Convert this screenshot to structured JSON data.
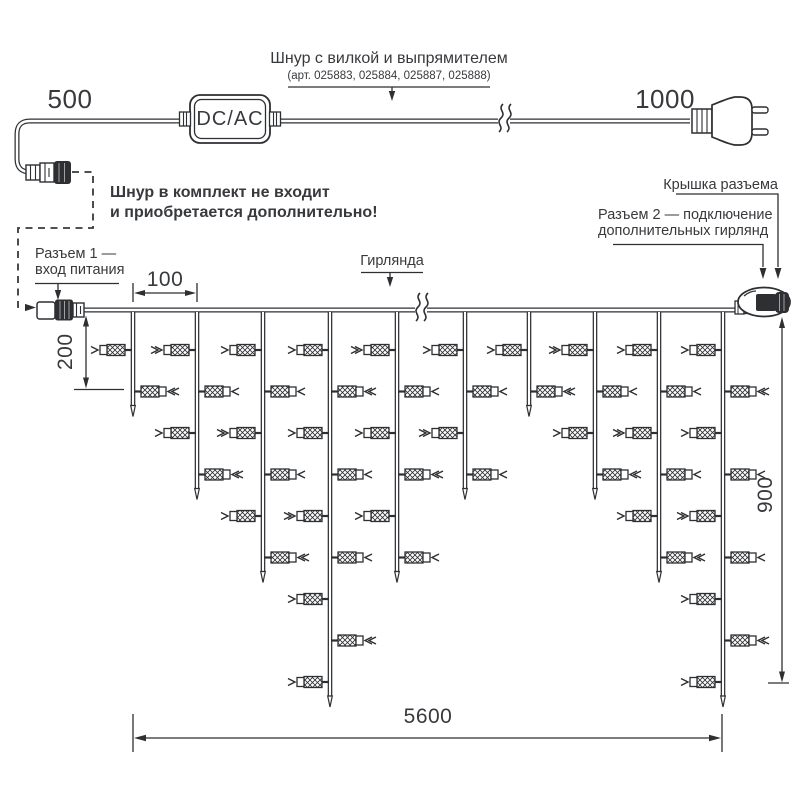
{
  "labels": {
    "cord_title": "Шнур с вилкой и выпрямителем",
    "cord_articles": "(арт. 025883, 025884, 025887, 025888)",
    "dim_500": "500",
    "dim_1000": "1000",
    "adapter": "DC/AC",
    "note_line1": "Шнур в комплект не входит",
    "note_line2": "и приобретается дополнительно!",
    "connector1_line1": "Разъем 1 —",
    "connector1_line2": "вход питания",
    "garland": "Гирлянда",
    "cap_label": "Крышка разъема",
    "connector2_line1": "Разъем 2 — подключение",
    "connector2_line2": "дополнительных гирлянд",
    "dim_100": "100",
    "dim_200": "200",
    "dim_900": "900",
    "dim_5600": "5600"
  },
  "diagram": {
    "colors": {
      "line": "#2d2f32",
      "text": "#37393c",
      "background": "#ffffff"
    },
    "cord": {
      "length_left_mm": 500,
      "length_right_mm": 1000,
      "adapter": "DC/AC",
      "break_x": 504,
      "wire_y": 121
    },
    "garland": {
      "main_wire_y": 310,
      "wire_x_start": 84,
      "wire_x_end": 740,
      "break_x": 421,
      "drop_xs": [
        133,
        197,
        263,
        330,
        397,
        465,
        529,
        595,
        659,
        723
      ],
      "lamps_per_drop": [
        2,
        4,
        6,
        9,
        6,
        4,
        2,
        4,
        6,
        9
      ],
      "lamp_level_start_y": 350,
      "lamp_level_spacing": 41.5,
      "drop_spacing_mm": 100,
      "short_drop_mm": 200,
      "height_mm": 900,
      "length_mm": 5600
    }
  }
}
